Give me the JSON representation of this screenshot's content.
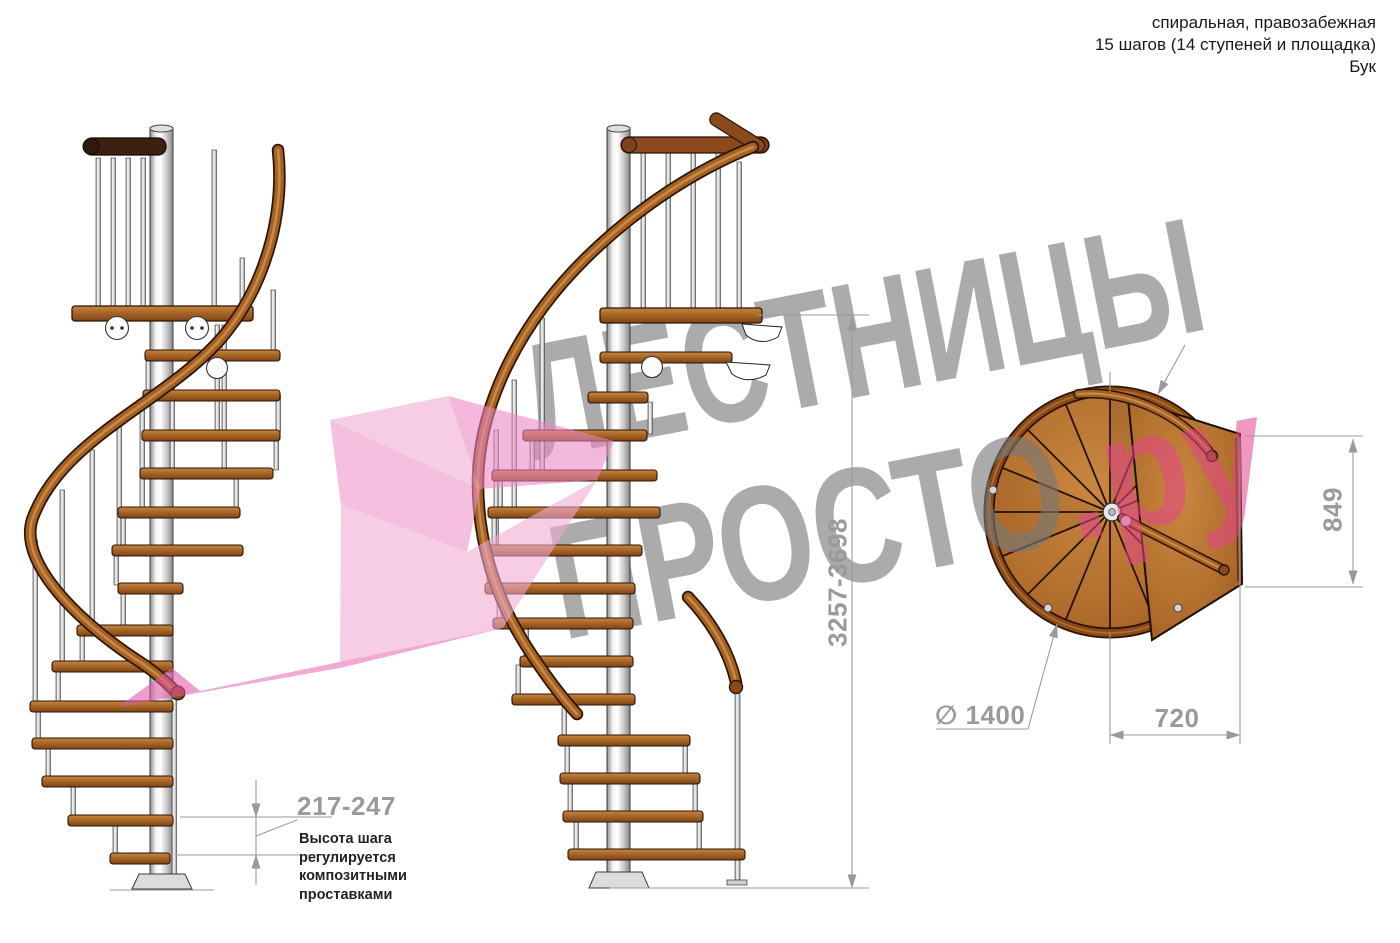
{
  "header": {
    "line1": "спиральная, правозабежная",
    "line2": "15 шагов (14 ступеней и площадка)",
    "line3": "Бук"
  },
  "watermark": {
    "word1": "ЛЕСТНИЦЫ",
    "word2": "ПРОСТО",
    "suffix": ".ру"
  },
  "dimensions": {
    "total_height": "3257-3698",
    "platform_depth": "849",
    "platform_width": "720",
    "diameter": "∅ 1400",
    "step_height": "217-247"
  },
  "note": {
    "line1": "Высота шага",
    "line2": "регулируется",
    "line3": "композитными",
    "line4": "проставками"
  },
  "colors": {
    "watermark_gray": "#777777",
    "watermark_pink": "#e3438d",
    "wood": "#a96728",
    "handrail": "#a4611f",
    "dimension_gray": "#9a9a9a"
  }
}
